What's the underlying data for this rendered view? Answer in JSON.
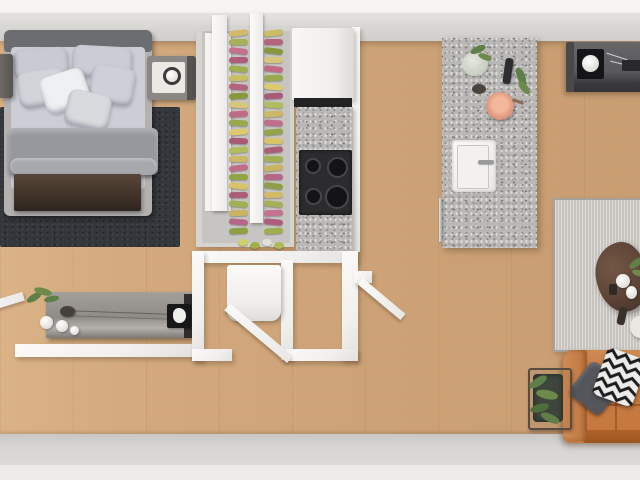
{
  "scene": {
    "title": "3D top-down floor plan render of a studio apartment",
    "rooms": [
      {
        "name": "bedroom",
        "furniture": [
          "double-bed",
          "headboard",
          "pillows",
          "duvet",
          "foot-bench",
          "left-nightstand",
          "right-nightstand-with-lamp",
          "dark-area-rug",
          "low-dresser-with-plant-vases-art-frame"
        ]
      },
      {
        "name": "closet",
        "furniture": [
          "wardrobe-frame",
          "sliding-rails",
          "hanging-clothes-rack",
          "shoes"
        ]
      },
      {
        "name": "kitchen",
        "furniture": [
          "refrigerator",
          "granite-counter",
          "four-burner-cooktop",
          "granite-island",
          "sink-with-faucet",
          "dishwasher-handle",
          "copper-pot",
          "cutting-greens",
          "glass-vase",
          "bottle"
        ]
      },
      {
        "name": "bathroom-hall",
        "furniture": [
          "shower-unit",
          "open-door-bathroom",
          "open-door-entry",
          "open-door-bedroom"
        ]
      },
      {
        "name": "living-room",
        "furniture": [
          "media-console-with-speaker",
          "light-area-rug",
          "round-dining-table",
          "white-chair",
          "leather-sofa",
          "gray-pillow",
          "chevron-pillow",
          "plant-stand"
        ]
      }
    ]
  },
  "colors": {
    "floor": "#d2a87c",
    "wall": "#d8d6d3",
    "trim": "#f6f5f3",
    "bedroom_rug": "#33363a",
    "bed_pillow": "#ccced6",
    "bed_duvet": "#97989e",
    "headboard": "#6b6d71",
    "bench": "#46372c",
    "granite": "#b9b8b6",
    "stove": "#2c2c2e",
    "living_rug": "#c7c4bf",
    "sofa": "#c6793f",
    "sofa_arm": "#d18c55",
    "table": "#5c4436",
    "console": "#59595b",
    "plant": "#5e7f48",
    "copper_pot": "#e29b82"
  },
  "closet": {
    "rack_colors": [
      "#d3b96a",
      "#a7b057",
      "#c4728f",
      "#b05c7c",
      "#9fae4e",
      "#c9bd66",
      "#b4637f",
      "#88983f",
      "#d6c77a",
      "#c06a85",
      "#9aa84e",
      "#ddca6f",
      "#a85a77",
      "#b0bd5f",
      "#cdb867",
      "#bf6e8b",
      "#93a348",
      "#d8c368",
      "#ab5e7a",
      "#a2b054",
      "#c9b561",
      "#b66687",
      "#8f9f45"
    ],
    "shoe_colors": [
      "#cfd06a",
      "#9fae4a",
      "#e0e0d8",
      "#b0b85a"
    ]
  }
}
